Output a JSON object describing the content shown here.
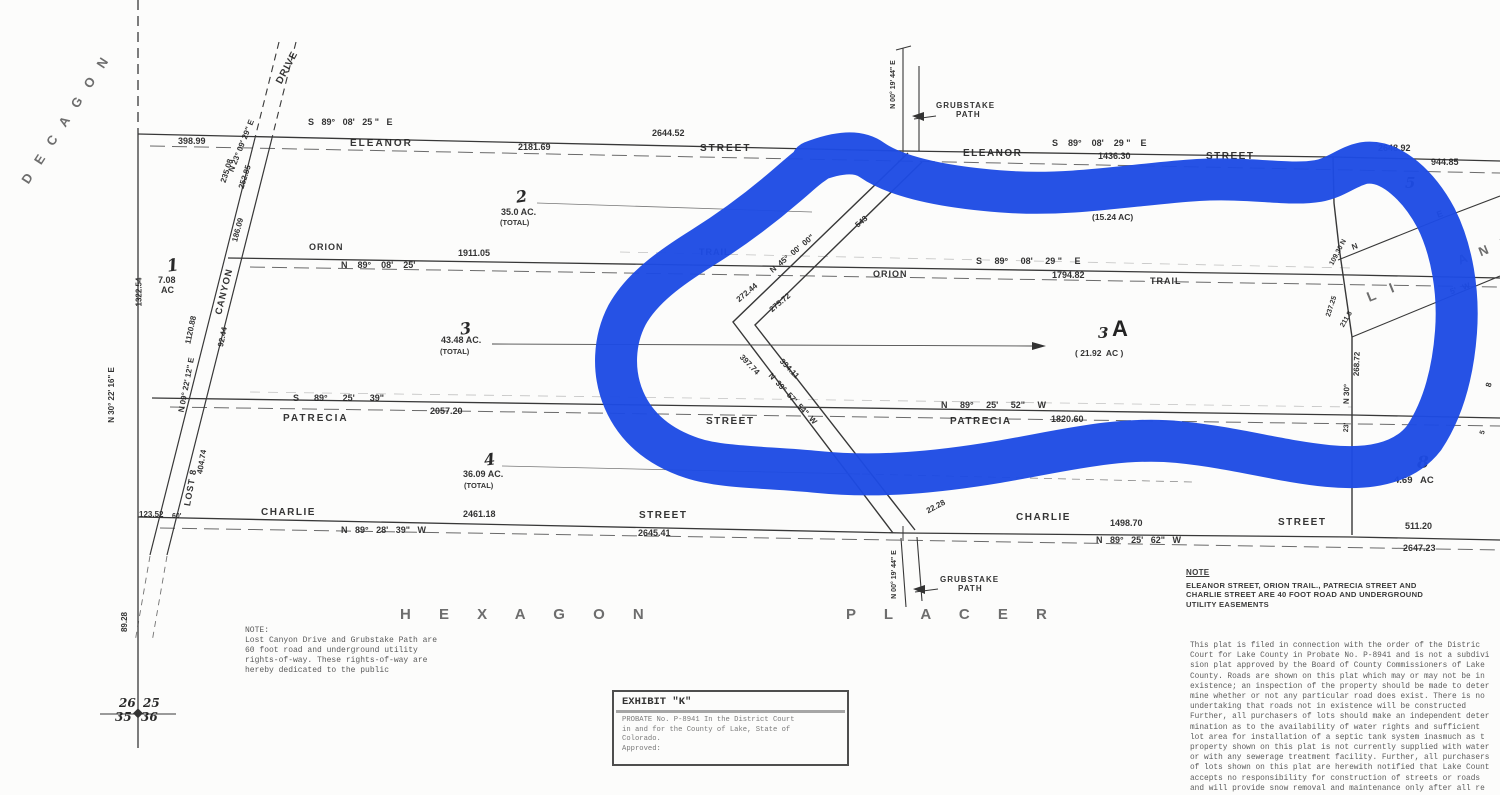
{
  "document": {
    "type": "scanned plat map",
    "claims": [
      "HEXAGON PLACER",
      "PLACER",
      "DECAGON",
      "LITTLE ANNIE"
    ]
  },
  "marker_color": "#1d4be4",
  "ink_color": "#383838",
  "map_labels": [
    {
      "n": "decagon-claim-name",
      "t": "D E C A G O N",
      "x": -10,
      "y": 112,
      "fs": 13,
      "rot": -57,
      "ls": 5,
      "cls": "stencil"
    },
    {
      "n": "placer-claim-name-top",
      "t": "P L A C E R",
      "x": 1293,
      "y": -13,
      "fs": 16,
      "ls": 9,
      "cls": "stencil"
    },
    {
      "n": "hexagon-claim-name",
      "t": "H E X A G O N",
      "x": 400,
      "y": 607,
      "fs": 15,
      "ls": 12,
      "cls": "stencil"
    },
    {
      "n": "placer-claim-name-bottom",
      "t": "P L A C E R",
      "x": 846,
      "y": 607,
      "fs": 15,
      "ls": 12,
      "cls": "stencil"
    },
    {
      "n": "little-annie-L-I",
      "t": "L I",
      "x": 1366,
      "y": 284,
      "fs": 14,
      "rot": -22,
      "ls": 6,
      "cls": "stencil"
    },
    {
      "n": "little-annie-ANN",
      "t": "A N N",
      "x": 1456,
      "y": 243,
      "fs": 13,
      "rot": -22,
      "ls": 5,
      "cls": "stencil"
    },
    {
      "n": "eleanor-bearing-left",
      "t": "S   89°   08'   25 \"   E",
      "x": 308,
      "y": 118,
      "fs": 9
    },
    {
      "n": "eleanor-dist-2644",
      "t": "2644.52",
      "x": 652,
      "y": 129,
      "fs": 9
    },
    {
      "n": "eleanor-dist-398",
      "t": "398.99",
      "x": 178,
      "y": 137,
      "fs": 9
    },
    {
      "n": "eleanor-dist-2181",
      "t": "2181.69",
      "x": 518,
      "y": 143,
      "fs": 9
    },
    {
      "n": "eleanor-name-left",
      "t": "ELEANOR",
      "x": 350,
      "y": 139,
      "fs": 10,
      "ls": 2
    },
    {
      "n": "eleanor-street-left",
      "t": "STREET",
      "x": 700,
      "y": 144,
      "fs": 10,
      "ls": 2
    },
    {
      "n": "eleanor-name-right",
      "t": "ELEANOR",
      "x": 963,
      "y": 149,
      "fs": 10,
      "ls": 1.5
    },
    {
      "n": "eleanor-bearing-right",
      "t": "S    89°    08'    29 \"    E",
      "x": 1052,
      "y": 139,
      "fs": 9
    },
    {
      "n": "eleanor-dist-1436",
      "t": "1436.30",
      "x": 1098,
      "y": 152,
      "fs": 9
    },
    {
      "n": "eleanor-street-right",
      "t": "STREET",
      "x": 1206,
      "y": 152,
      "fs": 10,
      "ls": 1.5
    },
    {
      "n": "eleanor-dist-2648",
      "t": "2648.92",
      "x": 1378,
      "y": 144,
      "fs": 9
    },
    {
      "n": "eleanor-dist-944",
      "t": "944.85",
      "x": 1431,
      "y": 158,
      "fs": 9
    },
    {
      "n": "orion-name-left",
      "t": "ORION",
      "x": 309,
      "y": 243,
      "fs": 9,
      "ls": 1
    },
    {
      "n": "orion-dist-1911",
      "t": "1911.05",
      "x": 458,
      "y": 249,
      "fs": 9
    },
    {
      "n": "orion-bearing-left",
      "t": "N    89°    08'    25'",
      "x": 341,
      "y": 261,
      "fs": 9
    },
    {
      "n": "orion-trail-left",
      "t": "TRAIL",
      "x": 699,
      "y": 248,
      "fs": 9,
      "ls": 1
    },
    {
      "n": "orion-bearing-right",
      "t": "S     89°     08'     29 \"     E",
      "x": 976,
      "y": 257,
      "fs": 9
    },
    {
      "n": "orion-name-right",
      "t": "ORION",
      "x": 873,
      "y": 270,
      "fs": 9,
      "ls": 1
    },
    {
      "n": "orion-dist-1794",
      "t": "1794.82",
      "x": 1052,
      "y": 271,
      "fs": 9
    },
    {
      "n": "orion-trail-right",
      "t": "TRAIL",
      "x": 1150,
      "y": 277,
      "fs": 9,
      "ls": 1
    },
    {
      "n": "patrecia-bearing-left",
      "t": "S      89°      25'      39\"",
      "x": 293,
      "y": 394,
      "fs": 9
    },
    {
      "n": "patrecia-dist-2057",
      "t": "2057.20",
      "x": 430,
      "y": 407,
      "fs": 9
    },
    {
      "n": "patrecia-name-left",
      "t": "PATRECIA",
      "x": 283,
      "y": 414,
      "fs": 10,
      "ls": 2
    },
    {
      "n": "patrecia-street-left",
      "t": "STREET",
      "x": 706,
      "y": 417,
      "fs": 10,
      "ls": 1.5
    },
    {
      "n": "patrecia-bearing-right",
      "t": "N     89°     25'     52\"     W",
      "x": 941,
      "y": 401,
      "fs": 9
    },
    {
      "n": "patrecia-dist-1820",
      "t": "1820.60",
      "x": 1051,
      "y": 415,
      "fs": 9
    },
    {
      "n": "patrecia-name-right",
      "t": "PATRECIA",
      "x": 950,
      "y": 417,
      "fs": 10,
      "ls": 1.5
    },
    {
      "n": "charlie-name-left",
      "t": "CHARLIE",
      "x": 261,
      "y": 508,
      "fs": 10,
      "ls": 1.5
    },
    {
      "n": "charlie-dist-2461",
      "t": "2461.18",
      "x": 463,
      "y": 510,
      "fs": 9
    },
    {
      "n": "charlie-street-left",
      "t": "STREET",
      "x": 639,
      "y": 511,
      "fs": 10,
      "ls": 1.5
    },
    {
      "n": "charlie-bearing-left",
      "t": "N   89°   28'   39\"   W",
      "x": 341,
      "y": 526,
      "fs": 9
    },
    {
      "n": "charlie-dist-2645",
      "t": "2645.41",
      "x": 638,
      "y": 529,
      "fs": 9
    },
    {
      "n": "charlie-name-right",
      "t": "CHARLIE",
      "x": 1016,
      "y": 513,
      "fs": 10,
      "ls": 1.5
    },
    {
      "n": "charlie-dist-1498",
      "t": "1498.70",
      "x": 1110,
      "y": 519,
      "fs": 9
    },
    {
      "n": "charlie-street-right",
      "t": "STREET",
      "x": 1278,
      "y": 518,
      "fs": 10,
      "ls": 1.5
    },
    {
      "n": "charlie-dist-511",
      "t": "511.20",
      "x": 1405,
      "y": 522,
      "fs": 9
    },
    {
      "n": "charlie-bearing-right",
      "t": "N   89°   25'   62\"   W",
      "x": 1096,
      "y": 536,
      "fs": 9
    },
    {
      "n": "charlie-dist-2647",
      "t": "2647.23",
      "x": 1403,
      "y": 544,
      "fs": 9
    },
    {
      "n": "grubstake-path-top-label1",
      "t": "GRUBSTAKE",
      "x": 936,
      "y": 102,
      "fs": 8,
      "ls": 1
    },
    {
      "n": "grubstake-path-top-label2",
      "t": "PATH",
      "x": 956,
      "y": 111,
      "fs": 8,
      "ls": 1
    },
    {
      "n": "grubstake-top-bearing",
      "t": "N 00° 19' 44\" E",
      "x": 869,
      "y": 81,
      "fs": 7,
      "rot": -90
    },
    {
      "n": "grubstake-path-bottom-label1",
      "t": "GRUBSTAKE",
      "x": 940,
      "y": 576,
      "fs": 8,
      "ls": 1
    },
    {
      "n": "grubstake-path-bottom-label2",
      "t": "PATH",
      "x": 958,
      "y": 585,
      "fs": 8,
      "ls": 1
    },
    {
      "n": "grubstake-bottom-bearing",
      "t": "N 00° 19' 44\" E",
      "x": 870,
      "y": 571,
      "fs": 7,
      "rot": -90
    },
    {
      "n": "grubstake-dist-2228",
      "t": "22.28",
      "x": 926,
      "y": 503,
      "fs": 8,
      "rot": -28
    },
    {
      "n": "lot1-number",
      "t": "1",
      "x": 167,
      "y": 258,
      "fs": 17,
      "rot": -8,
      "cls": "lot"
    },
    {
      "n": "lot1-acreage",
      "t": "7.08",
      "x": 158,
      "y": 276,
      "fs": 9
    },
    {
      "n": "lot1-acreage-unit",
      "t": "AC",
      "x": 161,
      "y": 286,
      "fs": 9
    },
    {
      "n": "lot2-number",
      "t": "2",
      "x": 516,
      "y": 189,
      "fs": 16,
      "rot": -8,
      "cls": "lot"
    },
    {
      "n": "lot2-acreage",
      "t": "35.0 AC.",
      "x": 501,
      "y": 208,
      "fs": 9
    },
    {
      "n": "lot2-total",
      "t": "(TOTAL)",
      "x": 500,
      "y": 219,
      "fs": 7.5
    },
    {
      "n": "lot3-number",
      "t": "3",
      "x": 460,
      "y": 321,
      "fs": 16,
      "rot": -8,
      "cls": "lot"
    },
    {
      "n": "lot3-acreage",
      "t": "43.48 AC.",
      "x": 441,
      "y": 336,
      "fs": 9
    },
    {
      "n": "lot3-total",
      "t": "(TOTAL)",
      "x": 440,
      "y": 348,
      "fs": 7.5
    },
    {
      "n": "lot4-number",
      "t": "4",
      "x": 484,
      "y": 452,
      "fs": 16,
      "rot": -8,
      "cls": "lot"
    },
    {
      "n": "lot4-acreage",
      "t": "36.09 AC.",
      "x": 463,
      "y": 470,
      "fs": 9
    },
    {
      "n": "lot4-total",
      "t": "(TOTAL)",
      "x": 464,
      "y": 482,
      "fs": 7.5
    },
    {
      "n": "lot3a-number-3",
      "t": "3",
      "x": 1098,
      "y": 326,
      "fs": 15,
      "cls": "lot"
    },
    {
      "n": "lot3a-number-A",
      "t": "A",
      "x": 1112,
      "y": 318,
      "fs": 22,
      "cls": "bigA"
    },
    {
      "n": "lot3a-acreage",
      "t": "( 21.92  AC )",
      "x": 1075,
      "y": 349,
      "fs": 8.5
    },
    {
      "n": "lot5-number",
      "t": "5",
      "x": 1405,
      "y": 176,
      "fs": 15,
      "cls": "lot"
    },
    {
      "n": "lot8-number",
      "t": "8",
      "x": 1417,
      "y": 455,
      "fs": 17,
      "cls": "lot"
    },
    {
      "n": "lot8-acreage",
      "t": "4.69   AC",
      "x": 1394,
      "y": 476,
      "fs": 9.5
    },
    {
      "n": "lot6-acreage",
      "t": "(15.24 AC)",
      "x": 1092,
      "y": 213,
      "fs": 8.5
    },
    {
      "n": "lost-canyon-drive-label",
      "t": "DRIVE",
      "x": 270,
      "y": 63,
      "fs": 10,
      "rot": -62,
      "ls": 1
    },
    {
      "n": "lost-canyon-bearing-upper",
      "t": "N 23° 09' 29\" E",
      "x": 214,
      "y": 142,
      "fs": 8,
      "rot": -68
    },
    {
      "n": "lost-canyon-dist-235",
      "t": "235.08",
      "x": 215,
      "y": 167,
      "fs": 8,
      "rot": -72
    },
    {
      "n": "lost-canyon-dist-252",
      "t": "252.85",
      "x": 233,
      "y": 173,
      "fs": 8,
      "rot": -72
    },
    {
      "n": "lost-canyon-dist-186",
      "t": "186.09",
      "x": 226,
      "y": 226,
      "fs": 8,
      "rot": -75
    },
    {
      "n": "lost-canyon-label",
      "t": "CANYON",
      "x": 201,
      "y": 287,
      "fs": 9.5,
      "rot": -76,
      "ls": 1
    },
    {
      "n": "lost-canyon-dist-1120",
      "t": "1120.88",
      "x": 177,
      "y": 326,
      "fs": 8,
      "rot": -78
    },
    {
      "n": "lost-canyon-dist-92",
      "t": "92.44",
      "x": 213,
      "y": 333,
      "fs": 8,
      "rot": -78
    },
    {
      "n": "lost-canyon-bearing-lower",
      "t": "N 09° 22' 12\" E",
      "x": 159,
      "y": 381,
      "fs": 8,
      "rot": -79
    },
    {
      "n": "lost-canyon-dist-404",
      "t": "404.74",
      "x": 190,
      "y": 458,
      "fs": 8,
      "rot": -80
    },
    {
      "n": "lost-label",
      "t": "LOST 8",
      "x": 172,
      "y": 483,
      "fs": 9,
      "rot": -80,
      "ls": 1
    },
    {
      "n": "west-dist-1322",
      "t": "1322.54",
      "x": 125,
      "y": 288,
      "fs": 8,
      "rot": -90
    },
    {
      "n": "west-bearing",
      "t": "N 30° 22' 16\" E",
      "x": 84,
      "y": 391,
      "fs": 8,
      "rot": -90
    },
    {
      "n": "lost-canyon-dist-123",
      "t": "123.52",
      "x": 139,
      "y": 511,
      "fs": 8
    },
    {
      "n": "lost-canyon-width-60",
      "t": "60'",
      "x": 172,
      "y": 513,
      "fs": 7
    },
    {
      "n": "corner-dist-8928",
      "t": "89.28",
      "x": 115,
      "y": 618,
      "fs": 8,
      "rot": -90
    },
    {
      "n": "section-26",
      "t": "26",
      "x": 119,
      "y": 697,
      "fs": 12,
      "cls": "lot"
    },
    {
      "n": "section-25",
      "t": "25",
      "x": 143,
      "y": 697,
      "fs": 12,
      "cls": "lot"
    },
    {
      "n": "section-35",
      "t": "35",
      "x": 115,
      "y": 711,
      "fs": 12,
      "cls": "lot"
    },
    {
      "n": "section-36",
      "t": "36",
      "x": 141,
      "y": 711,
      "fs": 12,
      "cls": "lot"
    },
    {
      "n": "chevron-bearing-upper",
      "t": "N  45°  00'  00\"",
      "x": 765,
      "y": 250,
      "fs": 8,
      "rot": -40
    },
    {
      "n": "chevron-dist-272",
      "t": "272.44",
      "x": 735,
      "y": 289,
      "fs": 8,
      "rot": -40
    },
    {
      "n": "chevron-dist-275",
      "t": "275.72",
      "x": 768,
      "y": 299,
      "fs": 8,
      "rot": -40
    },
    {
      "n": "chevron-dist-543",
      "t": "543",
      "x": 855,
      "y": 218,
      "fs": 8,
      "rot": -40
    },
    {
      "n": "chevron-dist-397",
      "t": "397.74",
      "x": 737,
      "y": 361,
      "fs": 8,
      "rot": 46
    },
    {
      "n": "chevron-dist-394",
      "t": "394.11",
      "x": 777,
      "y": 365,
      "fs": 8,
      "rot": 46
    },
    {
      "n": "chevron-bearing-lower",
      "t": "N  39°  57'  54\"  W",
      "x": 759,
      "y": 395,
      "fs": 8,
      "rot": 47
    },
    {
      "n": "east-boundary-dist-109",
      "t": "109.30 N",
      "x": 1324,
      "y": 249,
      "fs": 7,
      "rot": -62
    },
    {
      "n": "east-boundary-dist-237",
      "t": "237.25",
      "x": 1321,
      "y": 303,
      "fs": 7,
      "rot": -72
    },
    {
      "n": "east-boundary-dist-211",
      "t": "211.8",
      "x": 1338,
      "y": 316,
      "fs": 7,
      "rot": -60
    },
    {
      "n": "east-boundary-dist-268",
      "t": "268.72",
      "x": 1345,
      "y": 360,
      "fs": 8,
      "rot": -88
    },
    {
      "n": "east-boundary-bearing-n30",
      "t": "N 30°",
      "x": 1337,
      "y": 390,
      "fs": 8,
      "rot": -88
    },
    {
      "n": "east-boundary-bearing-23",
      "t": "23'",
      "x": 1342,
      "y": 424,
      "fs": 7,
      "rot": -88
    },
    {
      "n": "annie-line-e",
      "t": "E",
      "x": 1437,
      "y": 210,
      "fs": 9,
      "rot": -20
    },
    {
      "n": "annie-line-n",
      "t": "N",
      "x": 1352,
      "y": 243,
      "fs": 8,
      "rot": -20
    },
    {
      "n": "annie-line-5w",
      "t": "5'   W",
      "x": 1450,
      "y": 285,
      "fs": 8,
      "rot": -20
    },
    {
      "n": "east-edge-8",
      "t": "8",
      "x": 1487,
      "y": 381,
      "fs": 8,
      "rot": -75
    },
    {
      "n": "east-edge-5",
      "t": "5",
      "x": 1481,
      "y": 429,
      "fs": 7,
      "rot": -75
    }
  ],
  "note_left": {
    "lines": [
      "NOTE:",
      "Lost Canyon Drive and Grubstake Path are",
      "60 foot road and underground utility",
      "rights-of-way.  These rights-of-way are",
      "hereby dedicated to the public"
    ]
  },
  "exhibit": {
    "title": "EXHIBIT \"K\"",
    "lines": [
      "PROBATE No. P-8941 In the District Court",
      "in and for the County of Lake, State of",
      "Colorado.",
      "Approved:"
    ]
  },
  "note_right": {
    "title": "NOTE",
    "lines": [
      "ELEANOR STREET, ORION TRAIL., PATRECIA STREET AND",
      "CHARLIE STREET ARE 40 FOOT ROAD AND UNDERGROUND",
      "UTILITY EASEMENTS"
    ]
  },
  "legal": {
    "lines": [
      "This plat is filed in connection with the order of the Distric",
      "Court for Lake County in Probate No. P-8941 and is not a subdivi",
      "sion plat approved by the Board of County Commissioners of Lake",
      "County.  Roads are shown on this plat which may or may not be in",
      "existence; an inspection of the property should be made to deter",
      "mine whether or not any particular road does exist.  There is no",
      "undertaking that roads not in existence will be constructed",
      "Further, all purchasers of lots should make an independent deter",
      "mination as to the availability of water rights and sufficient",
      "lot area for installation of a septic tank system inasmuch as t",
      "property shown on this plat is not currently supplied with water",
      "or with any sewerage treatment facility.  Further, all purchasers",
      "of lots shown on this plat are herewith notified that Lake Count",
      "accepts no responsibility for construction of streets or roads",
      "and will provide snow removal and maintenance only after all re",
      "lected streets and roads have been constructed in accordance wit"
    ]
  }
}
